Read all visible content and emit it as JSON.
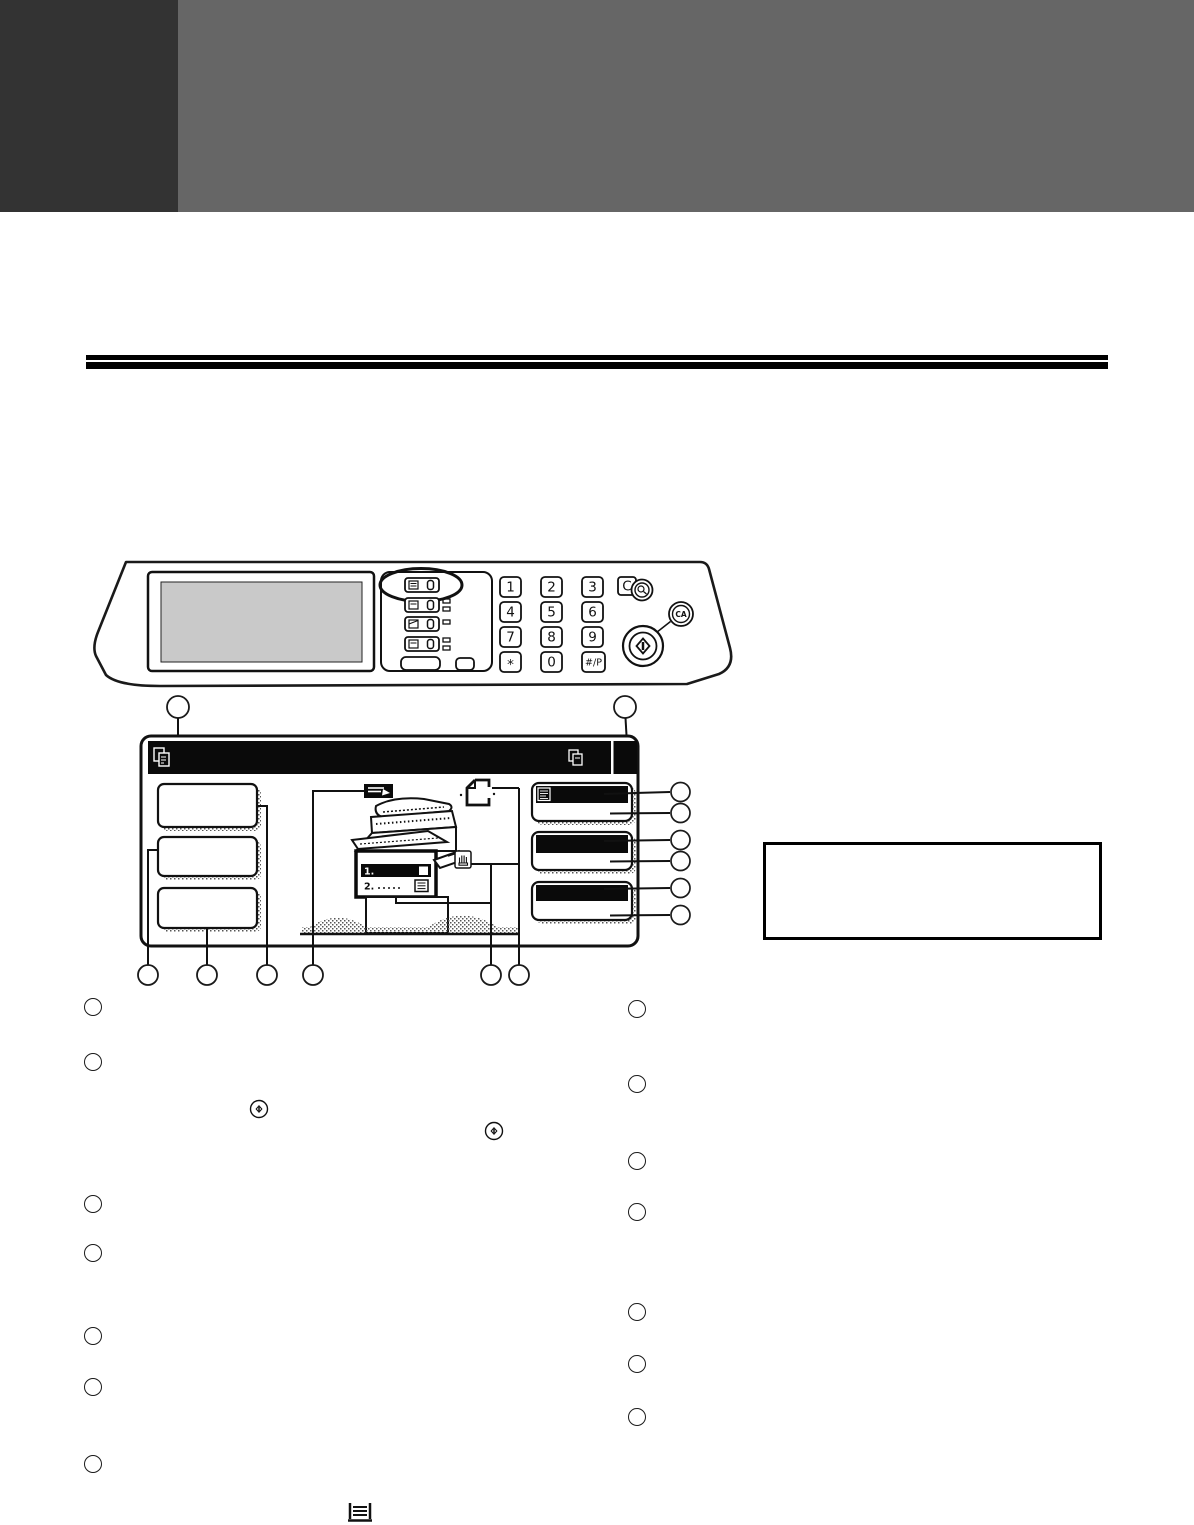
{
  "panel": {
    "keypad": {
      "keys": [
        "1",
        "2",
        "3",
        "4",
        "5",
        "6",
        "7",
        "8",
        "9",
        "*",
        "0",
        "#/P"
      ]
    },
    "clear_key_label": "C",
    "clear_all_key_label": "CA"
  },
  "screen": {
    "tray1_label": "1.",
    "tray2_label": "2."
  },
  "colors": {
    "corner_block": "#333333",
    "banner": "#666666",
    "ink": "#0a0a0a",
    "screen_gray": "#c9c9c9"
  }
}
